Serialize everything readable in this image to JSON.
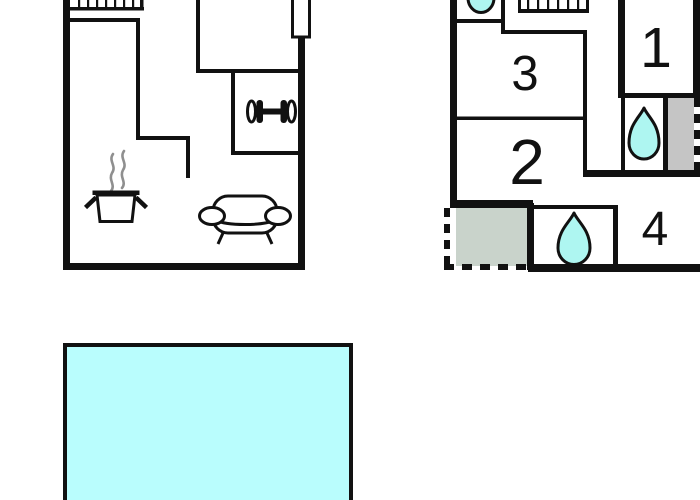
{
  "canvas": {
    "width": 700,
    "height": 500,
    "background": "#ffffff"
  },
  "colors": {
    "wall_black": "#111111",
    "water_cyan": "#aef6f1",
    "pool_cyan": "#b9fdfd",
    "storage_gray": "#c5c5c5",
    "terrace_gray_green": "#c9d3cb",
    "steam_gray": "#8f8f8f",
    "interior_white": "#ffffff"
  },
  "floor_plan_living": {
    "title": "living-level-floor-plan",
    "icons": [
      "staircase",
      "chimney",
      "dumbbell",
      "cooking-pot-with-steam",
      "sofa"
    ]
  },
  "floor_plan_bedrooms": {
    "title": "bedroom-level-floor-plan",
    "rooms": [
      {
        "label": "1"
      },
      {
        "label": "2"
      },
      {
        "label": "3"
      },
      {
        "label": "4"
      }
    ],
    "icons": [
      "washbasin",
      "staircase",
      "water-drop",
      "water-drop",
      "storage-box",
      "terrace"
    ]
  },
  "pool": {
    "type": "swimming-pool",
    "color": "#b9fdfd"
  }
}
